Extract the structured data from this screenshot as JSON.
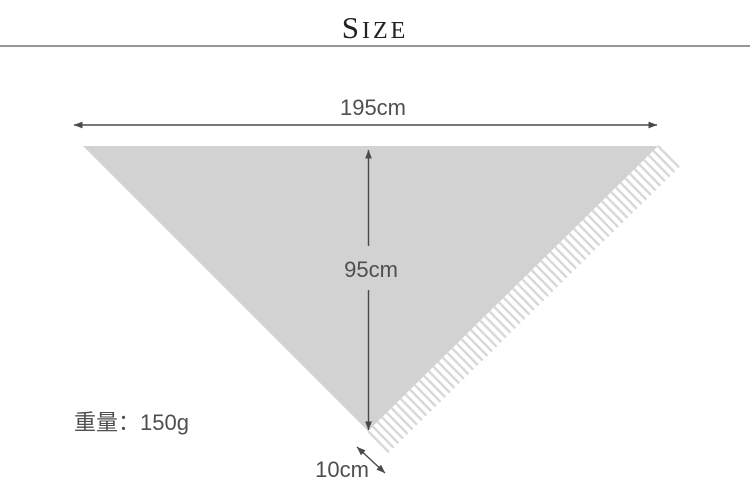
{
  "header": {
    "title_initial": "S",
    "title_rest": "IZE"
  },
  "diagram": {
    "width_label": "195cm",
    "height_label": "95cm",
    "fringe_label": "10cm",
    "weight_label": "重量：150g"
  },
  "colors": {
    "shawl_fill": "#d2d2d2",
    "fringe_stroke": "#d8d8d8",
    "arrow": "#4a4a4a",
    "label_text": "#4f4f4f",
    "title_text": "#222222",
    "divider": "#979797"
  }
}
